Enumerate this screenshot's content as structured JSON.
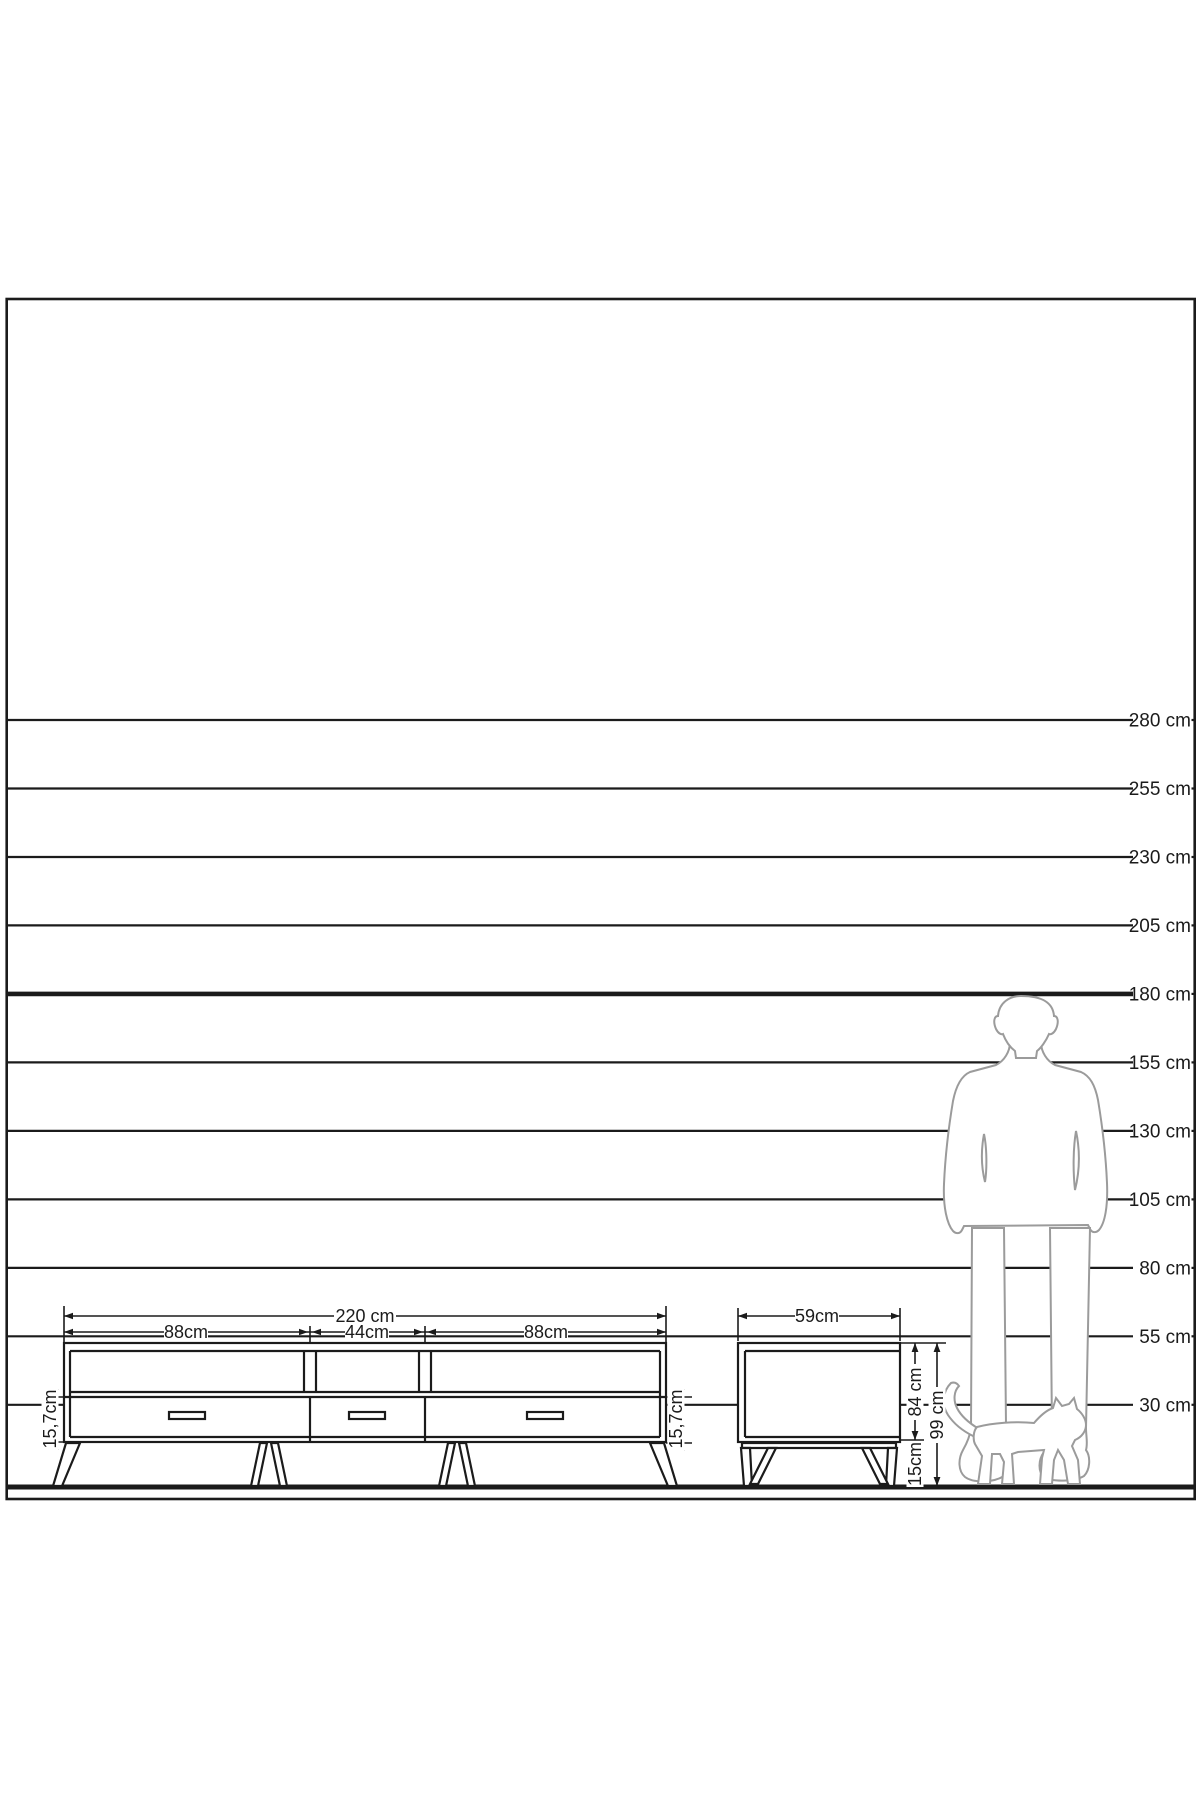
{
  "diagram": {
    "background": "#ffffff",
    "ink": "#1b1b1b",
    "figure_ink": "#9b9b9b",
    "scale": {
      "unit_suffix": " cm",
      "lines": [
        {
          "cm": 280,
          "label": "280 cm",
          "bold": false
        },
        {
          "cm": 255,
          "label": "255 cm",
          "bold": false
        },
        {
          "cm": 230,
          "label": "230 cm",
          "bold": false
        },
        {
          "cm": 205,
          "label": "205 cm",
          "bold": false
        },
        {
          "cm": 180,
          "label": "180 cm",
          "bold": true
        },
        {
          "cm": 155,
          "label": "155 cm",
          "bold": false
        },
        {
          "cm": 130,
          "label": "130 cm",
          "bold": false
        },
        {
          "cm": 105,
          "label": "105 cm",
          "bold": false
        },
        {
          "cm": 80,
          "label": "80 cm",
          "bold": false
        },
        {
          "cm": 55,
          "label": "55 cm",
          "bold": false
        },
        {
          "cm": 30,
          "label": "30 cm",
          "bold": false
        }
      ]
    },
    "tv_unit": {
      "overall_width_label": "220 cm",
      "section_labels": [
        "88cm",
        "44cm",
        "88cm"
      ],
      "front_height_label_left": "15,7cm",
      "front_height_label_right": "15,7cm",
      "drawer_count": 3,
      "open_shelf_count": 3
    },
    "side_unit": {
      "width_label": "59cm",
      "body_height_label": "84 cm",
      "leg_height_label": "15cm",
      "total_height_label": "99 cm"
    },
    "figures": {
      "person": "standing-man-silhouette",
      "cat": "walking-cat-silhouette"
    }
  }
}
